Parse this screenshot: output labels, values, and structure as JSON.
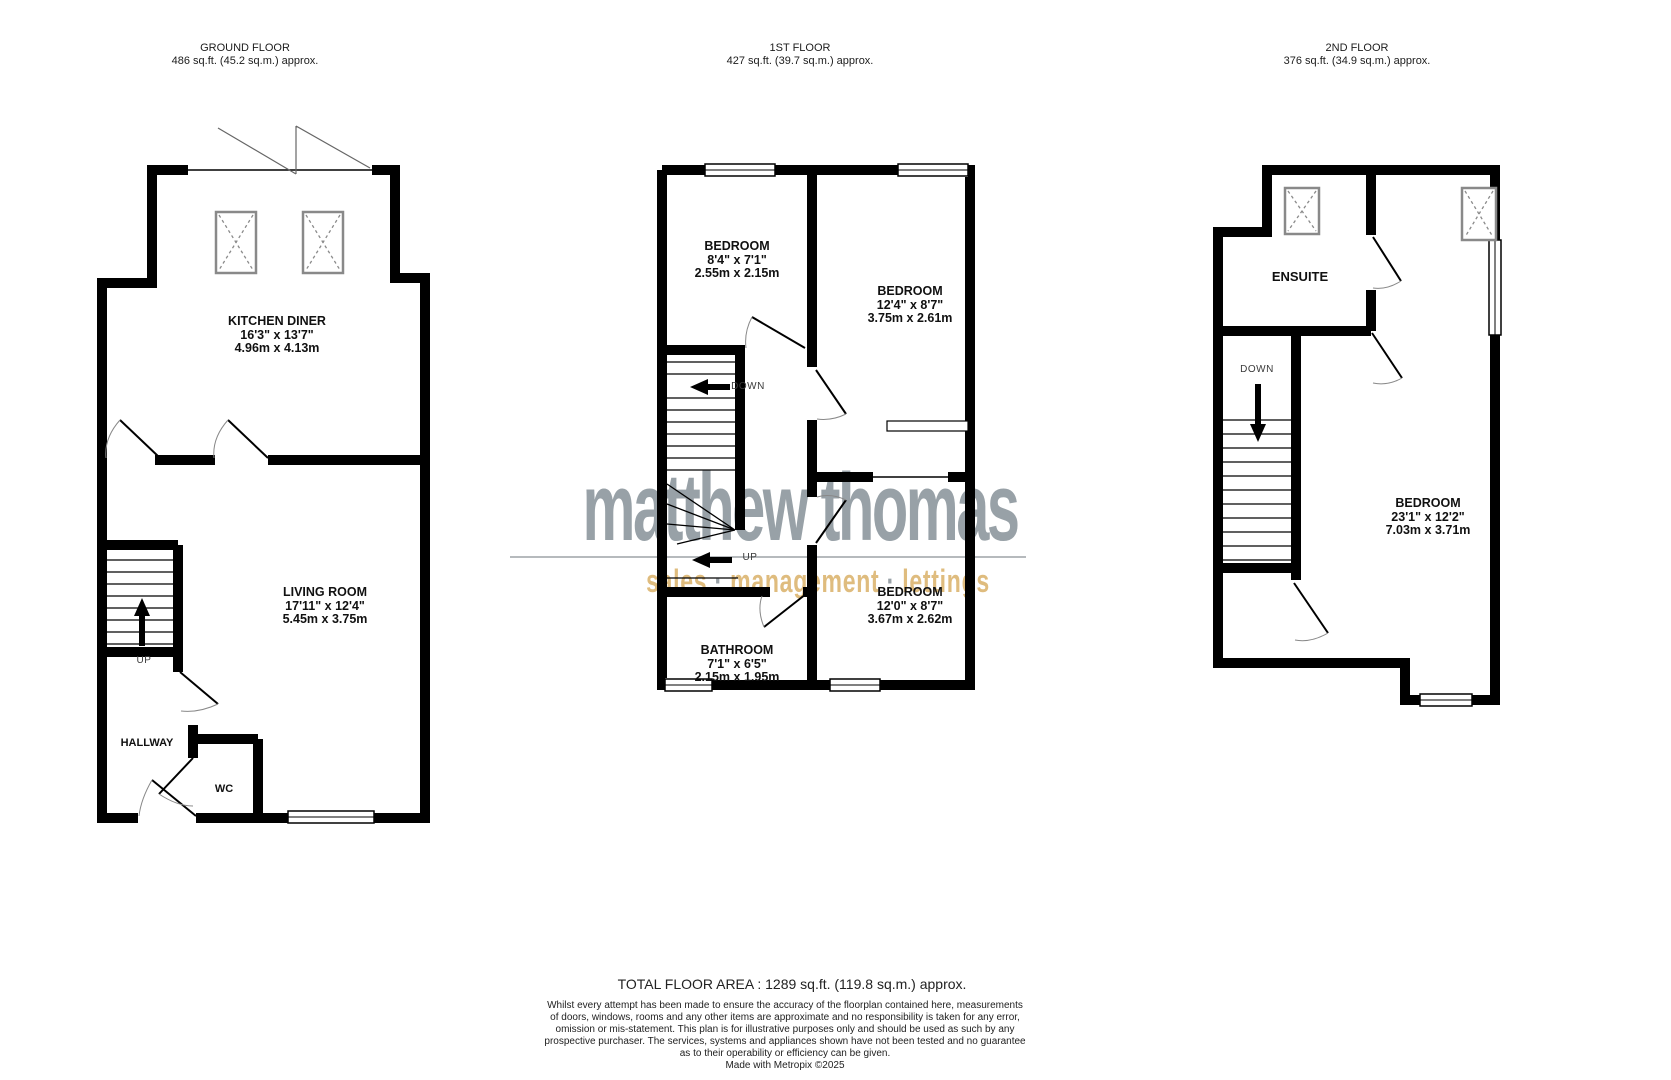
{
  "floors": [
    {
      "title": "GROUND FLOOR",
      "area": "486 sq.ft. (45.2 sq.m.) approx."
    },
    {
      "title": "1ST FLOOR",
      "area": "427 sq.ft. (39.7 sq.m.) approx."
    },
    {
      "title": "2ND FLOOR",
      "area": "376 sq.ft. (34.9 sq.m.) approx."
    }
  ],
  "rooms": {
    "kitchen": {
      "name": "KITCHEN DINER",
      "imperial": "16'3\"  x 13'7\"",
      "metric": "4.96m  x 4.13m"
    },
    "living": {
      "name": "LIVING ROOM",
      "imperial": "17'11\"  x 12'4\"",
      "metric": "5.45m  x 3.75m"
    },
    "hallway": {
      "name": "HALLWAY"
    },
    "wc": {
      "name": "WC"
    },
    "bedroom1": {
      "name": "BEDROOM",
      "imperial": "8'4\"  x 7'1\"",
      "metric": "2.55m  x 2.15m"
    },
    "bedroom2": {
      "name": "BEDROOM",
      "imperial": "12'4\"  x 8'7\"",
      "metric": "3.75m  x 2.61m"
    },
    "bedroom3": {
      "name": "BEDROOM",
      "imperial": "12'0\"  x 8'7\"",
      "metric": "3.67m  x 2.62m"
    },
    "bathroom": {
      "name": "BATHROOM",
      "imperial": "7'1\"  x 6'5\"",
      "metric": "2.15m  x 1.95m"
    },
    "ensuite": {
      "name": "ENSUITE"
    },
    "bedroom4": {
      "name": "BEDROOM",
      "imperial": "23'1\"  x 12'2\"",
      "metric": "7.03m  x 3.71m"
    }
  },
  "stairs": {
    "up": "UP",
    "down": "DOWN"
  },
  "watermark": {
    "brand": "matthew thomas",
    "words": [
      "sales",
      "management",
      "lettings"
    ],
    "separator": "·",
    "brand_color": "#98a1a7",
    "accent_color": "#dfbc7e"
  },
  "footer": {
    "total": "TOTAL FLOOR AREA : 1289 sq.ft. (119.8 sq.m.) approx.",
    "disclaimer_lines": [
      "Whilst every attempt has been made to ensure the accuracy of the floorplan contained here, measurements",
      "of doors, windows, rooms and any other items are approximate and no responsibility is taken for any error,",
      "omission or mis-statement. This plan is for illustrative purposes only and should be used as such by any",
      "prospective purchaser. The services, systems and appliances shown have not been tested and no guarantee",
      "as to their operability or efficiency can be given."
    ],
    "credit": "Made with Metropix ©2025"
  }
}
